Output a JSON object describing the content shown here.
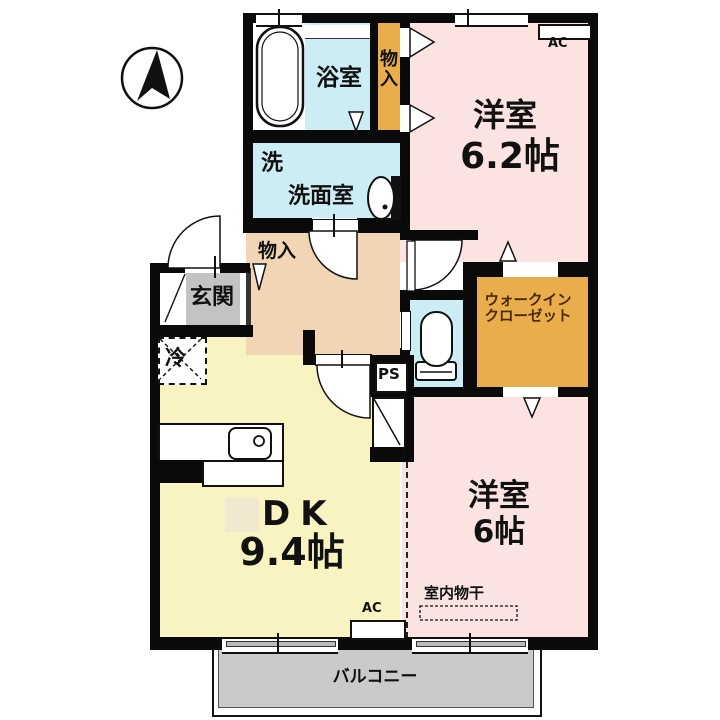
{
  "plan": {
    "type": "apartment-floor-plan",
    "labels": {
      "bathroom": "浴室",
      "storage_vertical": "物\n入",
      "washer": "洗",
      "washroom": "洗面室",
      "storage_hall": "物入",
      "entrance": "玄関",
      "fridge": "冷",
      "pipe_space": "PS",
      "walk_in_closet": "ウォークイン\nクローゼット",
      "room1_name": "洋室",
      "room1_size": "6.2帖",
      "room2_name": "洋室",
      "room2_size": "6帖",
      "dk_name": "DK",
      "dk_size": "9.4帖",
      "indoor_drying": "室内物干",
      "balcony": "バルコニー",
      "ac_top": "AC",
      "ac_bottom": "AC"
    },
    "colors": {
      "room_pink": "#fae3e1",
      "dk_yellow": "#f8f3c0",
      "hall_tan": "#f2d5b4",
      "wet_blue": "#cdedf4",
      "storage_orange": "#e9ae4b",
      "entrance_gray": "#c3c3c3",
      "balcony_gray": "#cacaca",
      "wall_black": "#0a0a0a",
      "wic_text": "#4a2800",
      "beige_square": "#f2e8cf"
    }
  }
}
